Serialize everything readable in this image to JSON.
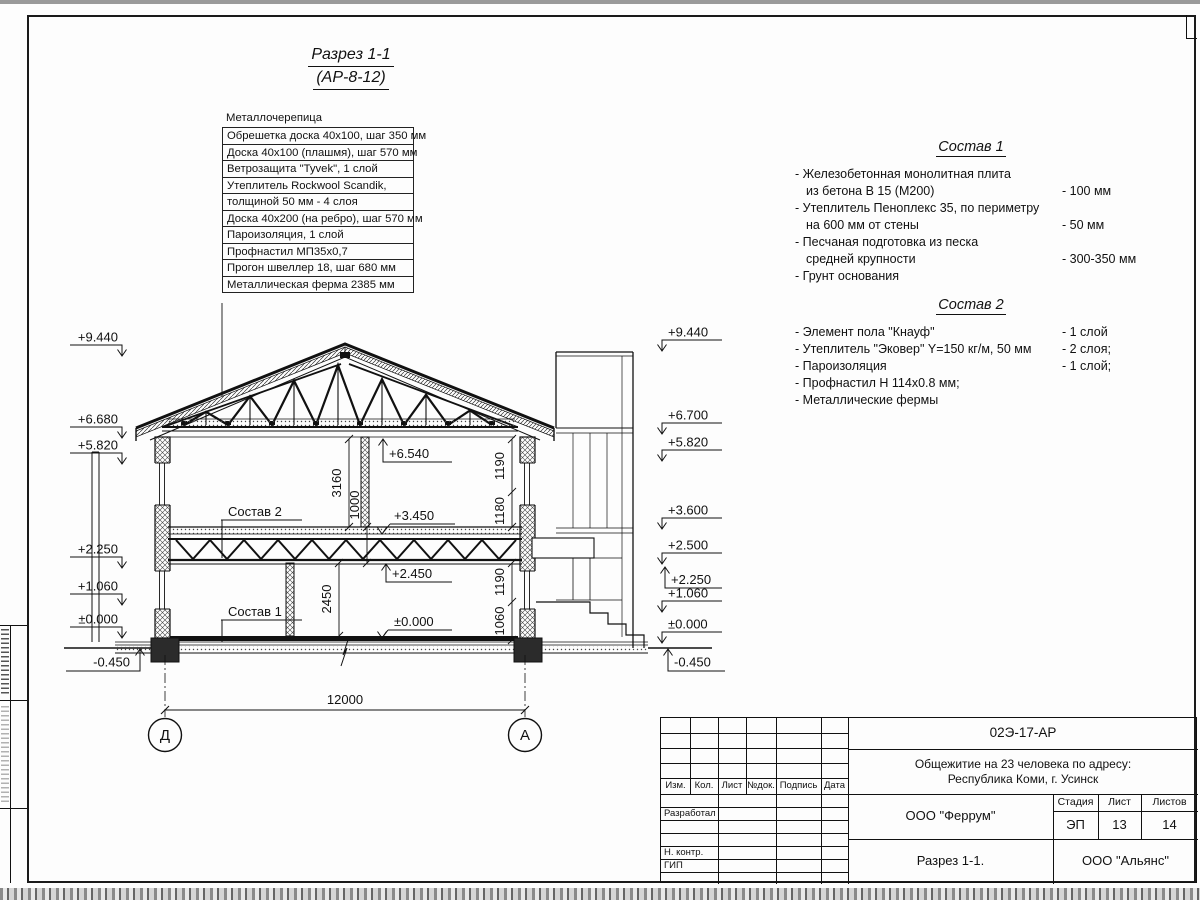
{
  "colors": {
    "ink": "#111111",
    "paper": "#fdfdfd"
  },
  "sheet": {
    "title_line1": "Разрез 1-1",
    "title_line2": "(АР-8-12)"
  },
  "roof_callout": {
    "top_label": "Металлочерепица",
    "rows": [
      "Обрешетка доска 40х100, шаг 350 мм",
      "Доска 40х100 (плашмя), шаг 570 мм",
      "Ветрозащита \"Tyvek\", 1 слой",
      "Утеплитель Rockwool Scandik,",
      "толщиной 50 мм - 4 слоя",
      "Доска 40х200 (на ребро), шаг 570 мм",
      "Пароизоляция, 1 слой",
      "Профнастил МП35х0,7",
      "Прогон швеллер 18, шаг 680 мм",
      "Металлическая ферма 2385 мм"
    ]
  },
  "sostav1": {
    "title": "Состав 1",
    "lines": [
      {
        "text": "- Железобетонная  монолитная плита",
        "value": ""
      },
      {
        "text": "из бетона В 15 (М200)",
        "value": "- 100 мм"
      },
      {
        "text": "- Утеплитель Пеноплекс 35, по периметру",
        "value": ""
      },
      {
        "text": "на 600 мм от стены",
        "value": "- 50 мм"
      },
      {
        "text": "- Песчаная подготовка из песка",
        "value": ""
      },
      {
        "text": "средней крупности",
        "value": "- 300-350 мм"
      },
      {
        "text": "- Грунт основания",
        "value": ""
      }
    ]
  },
  "sostav2": {
    "title": "Состав 2",
    "lines": [
      {
        "text": "- Элемент пола \"Кнауф\"",
        "value": "- 1 слой"
      },
      {
        "text": "- Утеплитель \"Эковер\" Y=150 кг/м, 50 мм",
        "value": "- 2 слоя;"
      },
      {
        "text": "- Пароизоляция",
        "value": "- 1 слой;"
      },
      {
        "text": "- Профнастил Н 114х0.8 мм;",
        "value": ""
      },
      {
        "text": "- Металлические фермы",
        "value": ""
      }
    ]
  },
  "marks": {
    "left": [
      "+9.440",
      "+6.680",
      "+5.820",
      "+2.250",
      "+1.060",
      "±0.000",
      "-0.450"
    ],
    "right": [
      "+9.440",
      "+6.700",
      "+5.820",
      "+3.600",
      "+2.500",
      "+2.250",
      "+1.060",
      "±0.000",
      "-0.450"
    ],
    "interior": [
      "+6.540",
      "+3.450",
      "+2.450",
      "±0.000"
    ],
    "labels": [
      "Состав 2",
      "Состав 1"
    ]
  },
  "dims": {
    "floor2_height": "3160",
    "floor_truss": "1000",
    "floor1_height": "2450",
    "win2_top": "1190",
    "win2_bottom": "1180",
    "win1_top": "1190",
    "win1_bottom": "1060",
    "span": "12000"
  },
  "axes": {
    "left": "Д",
    "right": "А"
  },
  "titleblock": {
    "doc_number": "02Э-17-АР",
    "project_line1": "Общежитие на 23 человека по адресу:",
    "project_line2": "Республика Коми, г. Усинск",
    "header_cols": [
      "Изм.",
      "Кол.",
      "Лист",
      "№док.",
      "Подпись",
      "Дата"
    ],
    "roles": [
      "Разработал",
      "Н. контр.",
      "ГИП"
    ],
    "org": "ООО \"Феррум\"",
    "stage_label": "Стадия",
    "sheet_label": "Лист",
    "sheets_label": "Листов",
    "stage": "ЭП",
    "sheet_no": "13",
    "sheets_total": "14",
    "drawing_title": "Разрез 1-1.",
    "contractor": "ООО \"Альянс\""
  }
}
